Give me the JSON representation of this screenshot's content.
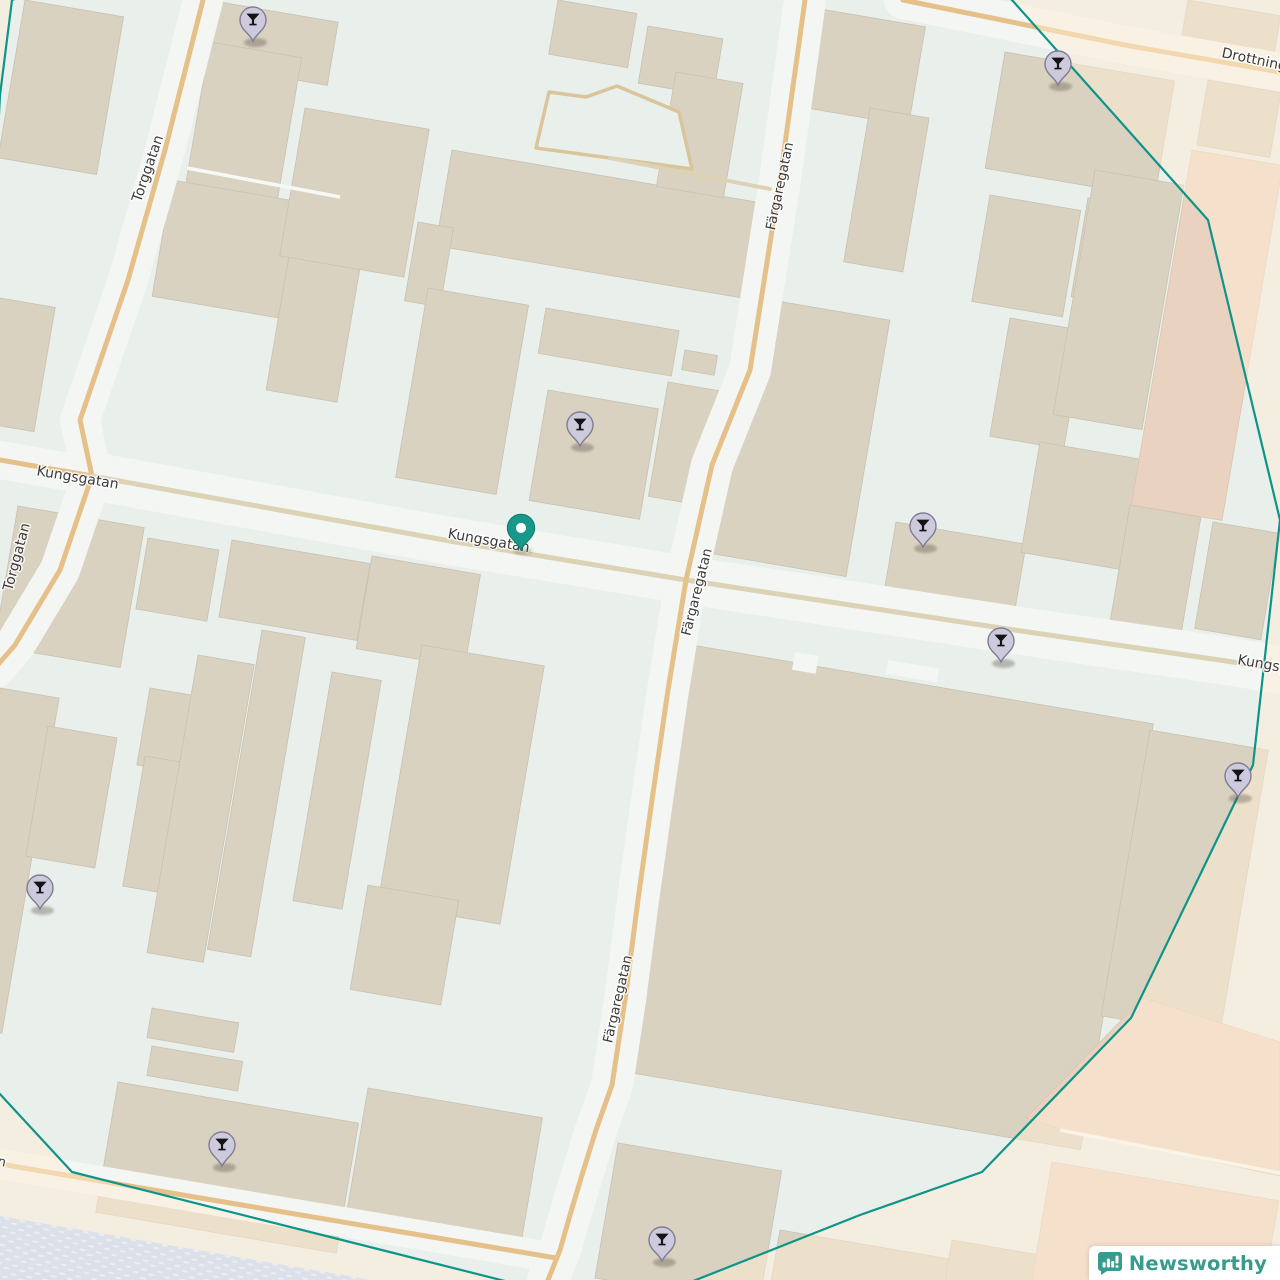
{
  "logo": {
    "text": "Newsworthy"
  },
  "map": {
    "colors": {
      "background": "#e9efeb",
      "corridor": "#f3f6f2",
      "building": "#d9d2c1",
      "building_stroke": "#c9c2b1",
      "peach_block": "#e9d3c0",
      "peach_stroke": "#dcc4af",
      "road_primary": "#e5c089",
      "road_secondary": "#dcd2b5",
      "outside_overlay": "rgba(255,238,213,0.5)",
      "water": "#dce0e9",
      "water_dash": "#eaedf3",
      "radius_circle": "#0e9488",
      "label_text": "#3b3b3b",
      "label_halo": "#ffffff",
      "poi_pin_fill": "#cecade",
      "poi_pin_stroke": "#807d92",
      "poi_glyph": "#141414",
      "selected_pin_fill": "#17988a",
      "selected_pin_stroke": "#0b7e72"
    },
    "streets": [
      {
        "name": "Torggatan",
        "kind": "primary",
        "corridor": 40,
        "width": 5,
        "points": [
          [
            203,
            0
          ],
          [
            165,
            150
          ],
          [
            128,
            280
          ],
          [
            80,
            420
          ],
          [
            92,
            476
          ],
          [
            60,
            570
          ],
          [
            15,
            645
          ],
          [
            -5,
            668
          ]
        ]
      },
      {
        "name": "Kungsgatan",
        "kind": "primary",
        "corridor": 38,
        "width": 5,
        "points": [
          [
            0,
            460
          ],
          [
            92,
            476
          ]
        ]
      },
      {
        "name": "Kungsgatan",
        "kind": "secondary",
        "corridor": 48,
        "width": 5,
        "points": [
          [
            92,
            476
          ],
          [
            450,
            541
          ],
          [
            686,
            580
          ],
          [
            1001,
            628
          ],
          [
            1233,
            662
          ],
          [
            1280,
            670
          ]
        ]
      },
      {
        "name": "Färgaregatan",
        "kind": "primary",
        "corridor": 42,
        "width": 5,
        "points": [
          [
            805,
            0
          ],
          [
            780,
            180
          ],
          [
            750,
            370
          ],
          [
            712,
            465
          ],
          [
            686,
            580
          ],
          [
            668,
            690
          ],
          [
            652,
            800
          ],
          [
            638,
            900
          ],
          [
            625,
            1000
          ],
          [
            612,
            1085
          ],
          [
            596,
            1130
          ],
          [
            582,
            1175
          ],
          [
            570,
            1215
          ],
          [
            560,
            1250
          ],
          [
            548,
            1280
          ]
        ]
      },
      {
        "name": "Drottninggatan",
        "kind": "primary",
        "corridor": 38,
        "width": 5,
        "points": [
          [
            903,
            0
          ],
          [
            1130,
            46
          ],
          [
            1280,
            72
          ]
        ]
      },
      {
        "name": "",
        "kind": "primary",
        "corridor": 30,
        "width": 5,
        "points": [
          [
            0,
            1164
          ],
          [
            230,
            1203
          ],
          [
            420,
            1235
          ],
          [
            556,
            1258
          ]
        ]
      },
      {
        "name": "",
        "kind": "secondary",
        "corridor": 0,
        "width": 4,
        "points": [
          [
            610,
            158
          ],
          [
            770,
            189
          ]
        ]
      }
    ],
    "street_labels": [
      {
        "text": "Kungsgatan",
        "x": 77,
        "y": 482,
        "rotate": 9.5,
        "size": 14,
        "anchor": "middle"
      },
      {
        "text": "Kungsgatan",
        "x": 488,
        "y": 545,
        "rotate": 10,
        "size": 14,
        "anchor": "middle"
      },
      {
        "text": "Kungsgatan",
        "x": 1237,
        "y": 664,
        "rotate": 10,
        "size": 14,
        "anchor": "start"
      },
      {
        "text": "Torggatan",
        "x": 152,
        "y": 170,
        "rotate": -71,
        "size": 14,
        "anchor": "middle"
      },
      {
        "text": "Torggatan",
        "x": 21,
        "y": 558,
        "rotate": -75,
        "size": 14,
        "anchor": "middle"
      },
      {
        "text": "Färgaregatan",
        "x": 784,
        "y": 187,
        "rotate": -78,
        "size": 13.5,
        "anchor": "middle"
      },
      {
        "text": "Färgaregatan",
        "x": 701,
        "y": 593,
        "rotate": -76,
        "size": 13.5,
        "anchor": "middle"
      },
      {
        "text": "Färgaregatan",
        "x": 622,
        "y": 1000,
        "rotate": -77,
        "size": 13.5,
        "anchor": "middle"
      },
      {
        "text": "Drottninggatan",
        "x": 1221,
        "y": 57,
        "rotate": 12,
        "size": 14,
        "anchor": "start"
      },
      {
        "text": "n",
        "x": -3,
        "y": 1165,
        "rotate": 12,
        "size": 13,
        "anchor": "start"
      }
    ],
    "grid_rotation_deg": 9.7,
    "buildings": [
      [
        25,
        0,
        100,
        160
      ],
      [
        208,
        0,
        132,
        64
      ],
      [
        210,
        42,
        93,
        152
      ],
      [
        172,
        180,
        170,
        118
      ],
      [
        290,
        250,
        72,
        142
      ],
      [
        0,
        298,
        56,
        126
      ],
      [
        305,
        108,
        126,
        150
      ],
      [
        452,
        150,
        312,
        97
      ],
      [
        418,
        222,
        36,
        80
      ],
      [
        428,
        288,
        102,
        192
      ],
      [
        546,
        308,
        135,
        46
      ],
      [
        685,
        350,
        33,
        20
      ],
      [
        548,
        390,
        112,
        112
      ],
      [
        668,
        382,
        74,
        116
      ],
      [
        558,
        0,
        80,
        55
      ],
      [
        648,
        26,
        76,
        58
      ],
      [
        676,
        72,
        68,
        116
      ],
      [
        815,
        8,
        112,
        100
      ],
      [
        870,
        108,
        60,
        156
      ],
      [
        1005,
        52,
        172,
        118
      ],
      [
        990,
        195,
        92,
        108
      ],
      [
        1088,
        198,
        66,
        100
      ],
      [
        1010,
        318,
        75,
        120
      ],
      [
        1095,
        170,
        90,
        248
      ],
      [
        1188,
        0,
        94,
        40
      ],
      [
        1208,
        80,
        74,
        66
      ],
      [
        742,
        295,
        150,
        260
      ],
      [
        896,
        522,
        132,
        90
      ],
      [
        1040,
        442,
        120,
        112
      ],
      [
        1165,
        350,
        50,
        146
      ],
      [
        1130,
        505,
        72,
        118
      ],
      [
        1213,
        522,
        67,
        108
      ],
      [
        18,
        506,
        128,
        142
      ],
      [
        148,
        538,
        72,
        72
      ],
      [
        232,
        540,
        140,
        78
      ],
      [
        372,
        556,
        110,
        94
      ],
      [
        0,
        688,
        60,
        340
      ],
      [
        48,
        726,
        70,
        132
      ],
      [
        150,
        688,
        48,
        78
      ],
      [
        145,
        756,
        44,
        132
      ],
      [
        198,
        655,
        57,
        302
      ],
      [
        262,
        630,
        44,
        324
      ],
      [
        332,
        672,
        50,
        232
      ],
      [
        422,
        645,
        124,
        262
      ],
      [
        368,
        885,
        92,
        106
      ],
      [
        152,
        1008,
        88,
        30
      ],
      [
        152,
        1046,
        92,
        30
      ],
      [
        118,
        1082,
        244,
        132
      ],
      [
        368,
        1088,
        177,
        126
      ],
      [
        692,
        645,
        468,
        432
      ],
      [
        1150,
        730,
        120,
        290
      ],
      [
        618,
        1143,
        166,
        137
      ],
      [
        780,
        1230,
        178,
        56
      ],
      [
        952,
        1240,
        110,
        42
      ]
    ],
    "building_notches": [
      [
        795,
        652,
        24,
        18
      ],
      [
        888,
        660,
        52,
        14
      ]
    ],
    "peach_blocks": [
      [
        1192,
        150,
        92,
        360
      ],
      [
        1052,
        1162,
        230,
        120
      ]
    ],
    "peach_polygon": [
      [
        1143,
        998
      ],
      [
        1280,
        1042
      ],
      [
        1280,
        1176
      ],
      [
        1058,
        1128
      ],
      [
        1026,
        1118
      ]
    ],
    "courtyard_outline": [
      [
        549,
        92
      ],
      [
        586,
        97
      ],
      [
        617,
        86
      ],
      [
        679,
        112
      ],
      [
        692,
        169
      ],
      [
        536,
        148
      ]
    ],
    "alleys": [
      [
        [
          187,
          168
        ],
        [
          340,
          197
        ]
      ],
      [
        [
          1060,
          1130
        ],
        [
          1280,
          1173
        ]
      ]
    ],
    "water_polygon": [
      [
        0,
        1216
      ],
      [
        372,
        1280
      ],
      [
        0,
        1280
      ]
    ],
    "highlight_circle": [
      [
        12,
        0
      ],
      [
        700,
        -230
      ],
      [
        1012,
        0
      ],
      [
        1208,
        220
      ],
      [
        1280,
        520
      ],
      [
        1253,
        765
      ],
      [
        1131,
        1018
      ],
      [
        982,
        1172
      ],
      [
        860,
        1215
      ],
      [
        620,
        1310
      ],
      [
        72,
        1172
      ],
      [
        -50,
        1040
      ],
      [
        0,
        95
      ]
    ],
    "markers": {
      "poi": [
        [
          253,
          41
        ],
        [
          1058,
          85
        ],
        [
          580,
          446
        ],
        [
          923,
          547
        ],
        [
          1001,
          662
        ],
        [
          1238,
          797
        ],
        [
          40,
          909
        ],
        [
          222,
          1166
        ],
        [
          662,
          1261
        ]
      ],
      "selected": [
        521,
        550
      ]
    }
  }
}
